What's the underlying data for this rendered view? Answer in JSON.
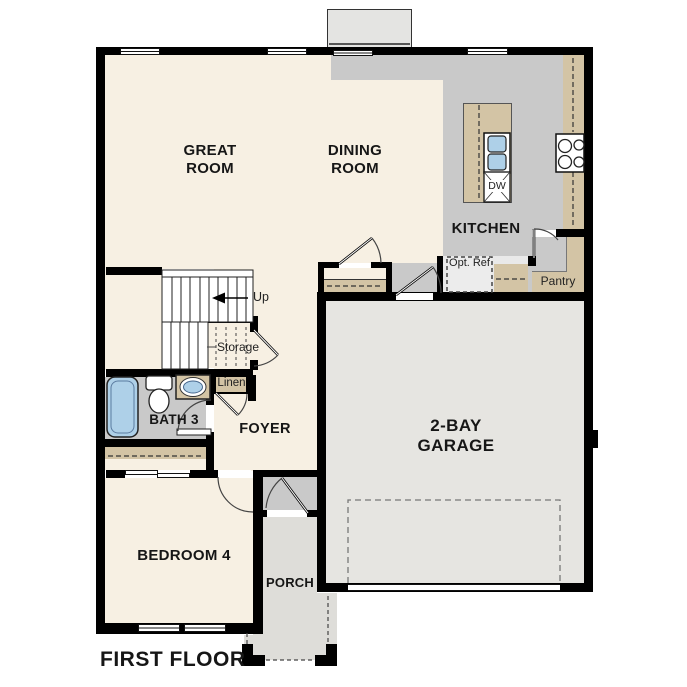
{
  "floor_plan": {
    "title": "FIRST FLOOR",
    "rooms": {
      "great_room": "GREAT ROOM",
      "dining_room": "DINING ROOM",
      "kitchen": "KITCHEN",
      "pantry": "Pantry",
      "garage": "2-BAY GARAGE",
      "foyer": "FOYER",
      "bath3": "BATH 3",
      "bedroom4": "BEDROOM 4",
      "porch": "PORCH"
    },
    "features": {
      "up": "Up",
      "storage": "Storage",
      "linen": "Linen",
      "opt_ref": "Opt. Ref",
      "dishwasher": "DW"
    },
    "colors": {
      "wall": "#000000",
      "floor": "#f7f0e3",
      "tile": "#c9c9c9",
      "counter": "#d3c4a5",
      "garage_floor": "#e6e5e1",
      "porch_floor": "#deddd9",
      "fixture": "#aed0e8",
      "chimney": "#e4e4e2"
    }
  }
}
